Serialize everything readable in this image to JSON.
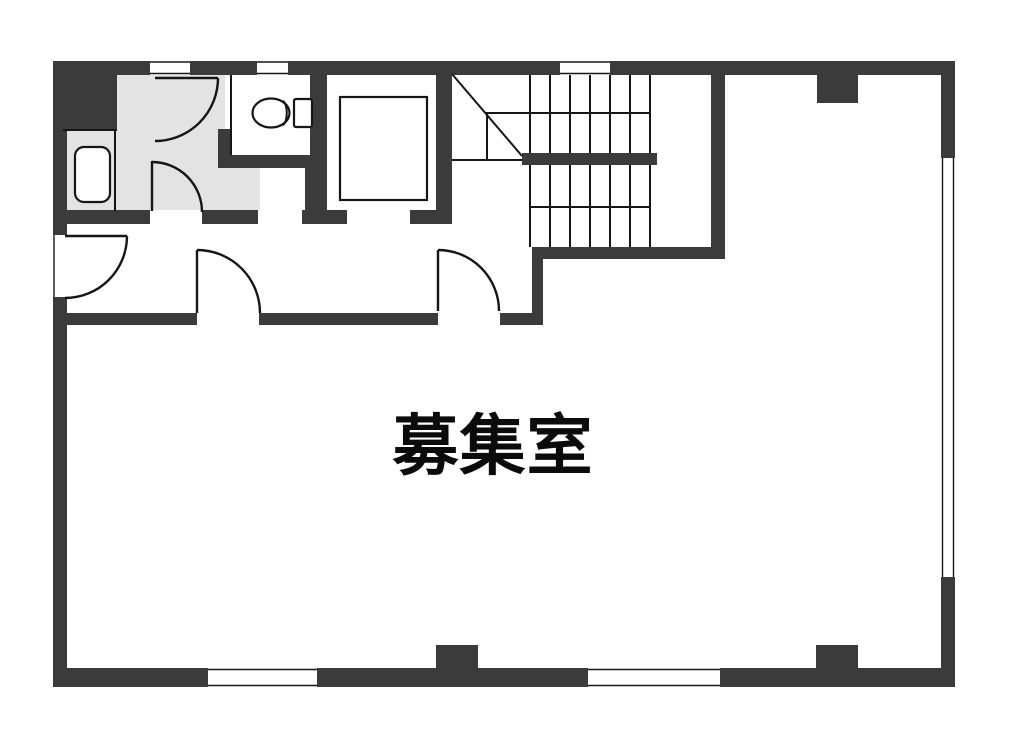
{
  "floorplan": {
    "room_label": "募集室",
    "colors": {
      "wall": "#3b3b3b",
      "floor": "#e3e3e3",
      "line": "#161616",
      "background": "#ffffff",
      "label": "#0b0b0b"
    },
    "symbols": {
      "toilet": "toilet-icon",
      "elevator": "elevator-shaft-icon",
      "staircase": "staircase-icon",
      "basin": "wash-basin-icon",
      "door": "door-swing-icon",
      "window": "window-icon"
    }
  }
}
